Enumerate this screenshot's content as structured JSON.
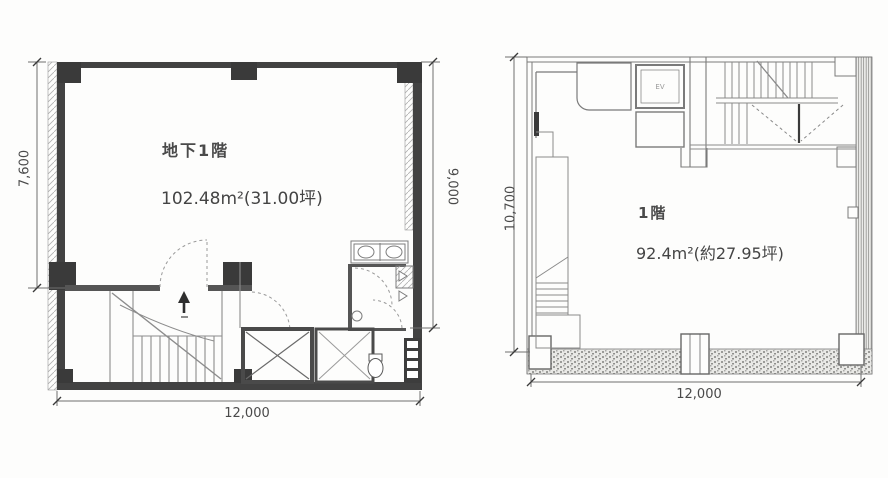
{
  "sheet": {
    "kind": "scanned building floor plans"
  },
  "basement": {
    "title": "地下1階",
    "area": "102.48m²(31.00坪)",
    "dim_left": "7,600",
    "dim_right": "9,000",
    "dim_bottom": "12,000"
  },
  "first_floor": {
    "title": "1階",
    "area": "92.4m²(約27.95坪)",
    "ev_label": "EV",
    "dim_left": "10,700",
    "dim_bottom": "12,000"
  },
  "colors": {
    "wall": "#424242",
    "thin_line": "#8a8a8a",
    "dim_text": "#4a4a4a"
  }
}
